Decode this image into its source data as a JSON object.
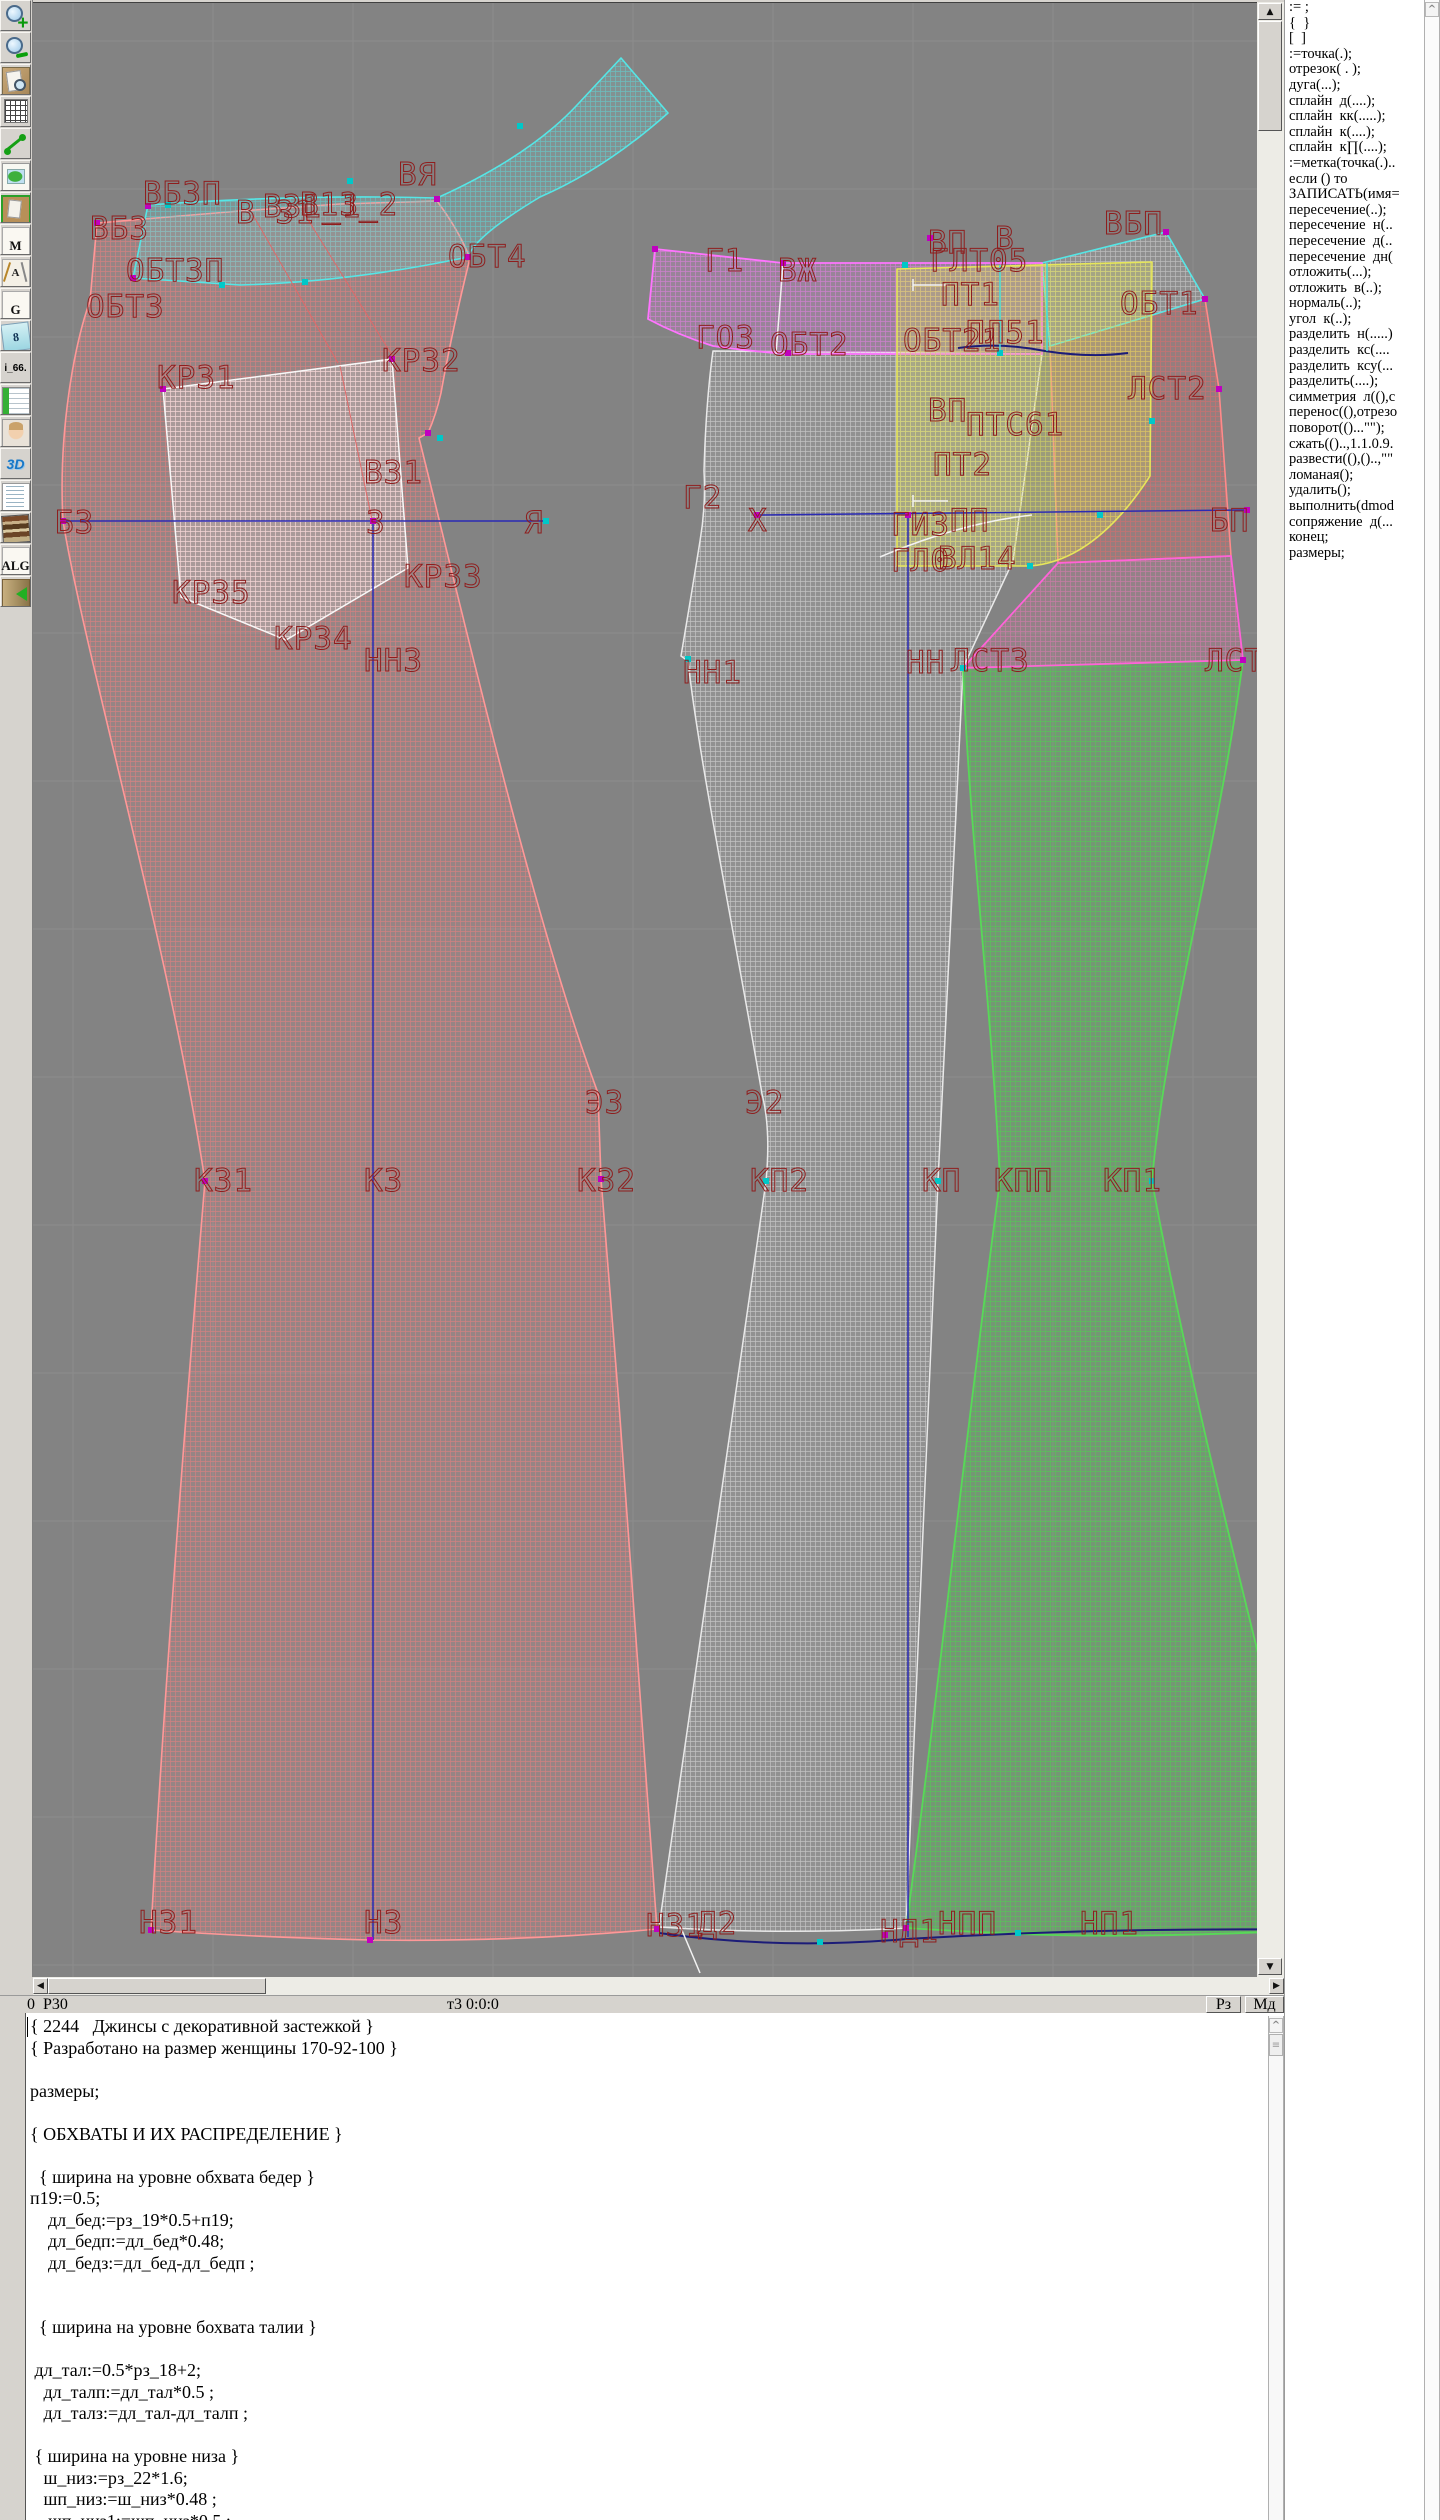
{
  "toolbar": {
    "buttons": [
      {
        "name": "zoom-in",
        "kind": "magnifier-plus",
        "glyph": ""
      },
      {
        "name": "zoom-out",
        "kind": "magnifier-minus",
        "glyph": ""
      },
      {
        "name": "print-preview",
        "kind": "page-magnifier",
        "glyph": ""
      },
      {
        "name": "grid",
        "kind": "grid",
        "glyph": ""
      },
      {
        "name": "segment",
        "kind": "segment",
        "glyph": ""
      },
      {
        "name": "map",
        "kind": "map",
        "glyph": ""
      },
      {
        "name": "pattern-frame",
        "kind": "pattern",
        "glyph": ""
      },
      {
        "name": "document-m",
        "kind": "text",
        "glyph": "M"
      },
      {
        "name": "draw-tools",
        "kind": "tools",
        "glyph": "A"
      },
      {
        "name": "document-g",
        "kind": "text",
        "glyph": "G"
      },
      {
        "name": "sizes",
        "kind": "papers",
        "glyph": "8"
      },
      {
        "name": "i66",
        "kind": "label",
        "glyph": "i_66."
      },
      {
        "name": "table",
        "kind": "table",
        "glyph": ""
      },
      {
        "name": "portrait",
        "kind": "portrait",
        "glyph": ""
      },
      {
        "name": "view-3d",
        "kind": "label3d",
        "glyph": "3D"
      },
      {
        "name": "text-list",
        "kind": "doclines",
        "glyph": ""
      },
      {
        "name": "books",
        "kind": "books",
        "glyph": ""
      },
      {
        "name": "algorithms",
        "kind": "text",
        "glyph": "ALG"
      },
      {
        "name": "exit",
        "kind": "exit",
        "glyph": ""
      }
    ]
  },
  "command_panel": {
    "items": [
      ":= ;",
      "{  }",
      "[  ]",
      ":=точка(.);",
      "отрезок( . );",
      "дуга(...);",
      "сплайн  д(....);",
      "сплайн  кк(.....);",
      "сплайн  к(....);",
      "сплайн  к∏(....);",
      ":=метка(точка(.)..",
      "если () то",
      "ЗАПИСАТЬ(имя=",
      "пересечение(..);",
      "пересечение  н(..",
      "пересечение  д(..",
      "пересечение  дн(",
      "отложить(...);",
      "отложить  в(..);",
      "нормаль(..);",
      "угол  к(..);",
      "разделить  н(.....)",
      "разделить  кс(....",
      "разделить  ксу(...",
      "разделить(....);",
      "симметрия  л((),с",
      "перенос((),отрезо",
      "поворот(()...\"\");",
      "сжать(()..,1.1.0.9.",
      "развести((),()..,\"\"",
      "ломаная();",
      "удалить();",
      "выполнить(dmod",
      "сопряжение  д(...",
      "конец;",
      "размеры;"
    ]
  },
  "status_bar": {
    "left": "0  Р30",
    "center": "т3 0:0:0",
    "buttons": [
      "Рз",
      "Мд"
    ]
  },
  "scroll_glyphs": {
    "up": "▲",
    "down": "▼",
    "left": "◀",
    "right": "▶",
    "chevron": "^",
    "thumb": "≡"
  },
  "code_editor": {
    "lines": [
      "{ 2244   Джинсы с декоративной застежкой }",
      "{ Разработано на размер женщины 170-92-100 }",
      "",
      "размеры;",
      "",
      "{ ОБХВАТЫ И ИХ РАСПРЕДЕЛЕНИЕ }",
      "",
      "  { ширина на уровне обхвата бедер }",
      "п19:=0.5;",
      "    дл_бед:=рз_19*0.5+п19;",
      "    дл_бедп:=дл_бед*0.48;",
      "    дл_бедз:=дл_бед-дл_бедп ;",
      "",
      "",
      "  { ширина на уровне бохвата талии }",
      "",
      " дл_тал:=0.5*рз_18+2;",
      "   дл_талп:=дл_тал*0.5 ;",
      "   дл_талз:=дл_тал-дл_талп ;",
      "",
      " { ширина на уровне низа }",
      "   ш_низ:=рз_22*1.6;",
      "   шп_низ:=ш_низ*0.48 ;",
      "    шп_низ1:=шп_низ*0.5 ;"
    ]
  },
  "canvas": {
    "background": "#838383",
    "grid_color": "#8d8d8d",
    "label_color": "#8f1d1d",
    "grid": {
      "vx": [
        73,
        213,
        353,
        493,
        633,
        773,
        913,
        1053,
        1193
      ],
      "hy": [
        40,
        188,
        336,
        484,
        632,
        780,
        928,
        1076,
        1224,
        1372,
        1520,
        1668,
        1816,
        1964
      ]
    },
    "pieces": [
      {
        "name": "back-left",
        "stroke": "#ff9898",
        "sw": 1.6,
        "mesh": "#ff7d7d",
        "tint": "#ff8888",
        "tintOp": 0.16,
        "meshOp": 0.55,
        "path": "M97 222 L240 210 L340 203 L437 200 C452 220 463 240 470 257 Q452 330 441 392 Q436 414 428 432 L419 437 C455 580 530 910 598 1092 L601 1178 C622 1430 641 1700 657 1928 Q520 1941 370 1939 Q250 1936 151 1929 C165 1680 185 1420 205 1180 C170 950 85 655 63 520 C58 430 75 340 90 300 Z"
      },
      {
        "name": "pocket",
        "stroke": "#f8f8f8",
        "sw": 1.5,
        "mesh": "#ffffff",
        "tint": "#ffffff",
        "tintOp": 0.18,
        "meshOp": 0.6,
        "path": "M163 388 L392 358 L408 567 L286 639 L181 596 Z"
      },
      {
        "name": "yoke-band",
        "stroke": "#55e6e6",
        "sw": 1.6,
        "mesh": "#5adada",
        "tint": "#80d8d8",
        "tintOp": 0.18,
        "meshOp": 0.6,
        "path": "M148 204 Q300 193 437 197 Q530 155 578 103 L621 57 L668 112 Q605 168 540 196 Q475 235 468 256 Q350 281 240 284 L133 277 Z"
      },
      {
        "name": "front-right",
        "stroke": "#e9e9e9",
        "sw": 1.5,
        "mesh": "#f2f2f2",
        "tint": "#e8e8e8",
        "tintOp": 0.14,
        "meshOp": 0.5,
        "path": "M713 350 L1042 353 L1013 560 L963 667 C955 840 945 1020 938 1180 C925 1430 915 1680 906 1927 Q780 1934 659 1926 C695 1680 731 1430 766 1180 Q771 1128 762 1093 C737 945 699 760 688 660 L681 655 Q692 590 700 540 Q706 505 704 470 Q706 400 713 350 Z"
      },
      {
        "name": "side-green",
        "stroke": "#58d858",
        "sw": 1.8,
        "mesh": "#4ed04e",
        "tint": "#58c858",
        "tintOp": 0.3,
        "meshOp": 0.7,
        "path": "M963 667 L1243 659 C1218 850 1166 1020 1152 1180 C1200 1440 1272 1700 1326 1928 Q1150 1938 1018 1933 Q955 1930 906 1927 C940 1680 966 1430 1000 1180 C992 1010 970 840 963 667 Z"
      },
      {
        "name": "panel-red",
        "stroke": "#ff8a8a",
        "sw": 1.6,
        "mesh": "#e86a6a",
        "tint": "#d86868",
        "tintOp": 0.22,
        "meshOp": 0.6,
        "path": "M1050 345 L1205 298 L1219 388 L1231 555 L1058 562 Z"
      },
      {
        "name": "panel-pink",
        "stroke": "#ff62d8",
        "sw": 1.8,
        "mesh": "#e878b8",
        "tint": "#d87898",
        "tintOp": 0.2,
        "meshOp": 0.6,
        "path": "M1058 562 L1231 555 L1243 659 L963 667 Z"
      },
      {
        "name": "top-right-quad",
        "stroke": "#55e6e6",
        "sw": 1.6,
        "mesh": "#e8e8e8",
        "tint": "#d8d8d8",
        "tintOp": 0.14,
        "meshOp": 0.5,
        "path": "M1042 262 L1166 231 L1205 298 L1050 345 Z"
      },
      {
        "name": "waistband-front",
        "stroke": "#ff74ff",
        "sw": 1.8,
        "mesh": "#f07df0",
        "tint": "#ee82ee",
        "tintOp": 0.2,
        "meshOp": 0.6,
        "path": "M655 248 Q718 255 783 262 L1042 262 L1042 353 L788 353 Q748 350 713 345 Q678 334 648 318 Z"
      },
      {
        "name": "fly-yellow",
        "stroke": "#e6e65a",
        "sw": 1.6,
        "mesh": "#d8d860",
        "tint": "#d8d868",
        "tintOp": 0.3,
        "meshOp": 0.7,
        "path": "M897 268 L1152 261 L1150 475 Q1095 560 1030 565 L897 565 Z"
      }
    ],
    "lines": [
      {
        "c": "#2a2ab4",
        "w": 1.5,
        "d": "M63 520 L545 520"
      },
      {
        "c": "#2a2ab4",
        "w": 1.5,
        "d": "M373 520 L373 1939"
      },
      {
        "c": "#2a2ab4",
        "w": 1.5,
        "d": "M757 514 L1247 509"
      },
      {
        "c": "#2a2ab4",
        "w": 1.5,
        "d": "M908 514 L908 1936"
      },
      {
        "c": "#1c1c78",
        "w": 2,
        "d": "M659 1932 Q780 1949 906 1938 Q1110 1926 1326 1929"
      },
      {
        "c": "#1c1c78",
        "w": 2,
        "d": "M958 347 Q1000 341 1045 350 Q1090 357 1128 352"
      },
      {
        "c": "#f2f2f2",
        "w": 1.5,
        "d": "M783 263 L776 353"
      },
      {
        "c": "#f2f2f2",
        "w": 1.5,
        "d": "M880 556 Q960 522 1032 514"
      },
      {
        "c": "#f2f2f2",
        "w": 1.5,
        "d": "M681 1927 L700 1972"
      },
      {
        "c": "#f2f2f2",
        "w": 1.5,
        "d": "M913 278 L913 290 M913 284 L948 284"
      },
      {
        "c": "#f2f2f2",
        "w": 1.5,
        "d": "M913 494 L913 506 M913 500 L948 500"
      },
      {
        "c": "#40dcdc",
        "w": 1.5,
        "d": "M1000 264 L1000 350"
      },
      {
        "c": "#40dcdc",
        "w": 1.5,
        "d": "M1047 262 L1047 350"
      },
      {
        "c": "#e06868",
        "w": 1,
        "d": "M253 214 L338 362"
      },
      {
        "c": "#e06868",
        "w": 1,
        "d": "M302 209 L395 359"
      },
      {
        "c": "#e06868",
        "w": 1,
        "d": "M340 365 L372 519"
      }
    ],
    "markers_magenta": [
      [
        97,
        222
      ],
      [
        148,
        205
      ],
      [
        133,
        277
      ],
      [
        163,
        388
      ],
      [
        392,
        358
      ],
      [
        468,
        256
      ],
      [
        437,
        198
      ],
      [
        63,
        520
      ],
      [
        373,
        520
      ],
      [
        151,
        1929
      ],
      [
        370,
        1939
      ],
      [
        657,
        1928
      ],
      [
        783,
        262
      ],
      [
        788,
        352
      ],
      [
        930,
        237
      ],
      [
        1166,
        231
      ],
      [
        1205,
        298
      ],
      [
        1219,
        388
      ],
      [
        1243,
        659
      ],
      [
        906,
        1927
      ],
      [
        1326,
        1928
      ],
      [
        885,
        1934
      ],
      [
        757,
        514
      ],
      [
        1247,
        509
      ],
      [
        655,
        248
      ],
      [
        428,
        432
      ],
      [
        908,
        514
      ],
      [
        601,
        1178
      ],
      [
        205,
        1180
      ]
    ],
    "markers_cyan": [
      [
        222,
        284
      ],
      [
        305,
        281
      ],
      [
        168,
        204
      ],
      [
        905,
        264
      ],
      [
        1000,
        352
      ],
      [
        688,
        658
      ],
      [
        963,
        667
      ],
      [
        1100,
        514
      ],
      [
        1018,
        1932
      ],
      [
        820,
        1941
      ],
      [
        546,
        520
      ],
      [
        1152,
        420
      ],
      [
        1030,
        565
      ],
      [
        440,
        437
      ],
      [
        766,
        1180
      ],
      [
        938,
        1180
      ],
      [
        1152,
        1180
      ],
      [
        350,
        180
      ],
      [
        520,
        125
      ]
    ],
    "labels": [
      {
        "t": "ВБЗП",
        "x": 143,
        "y": 203
      },
      {
        "t": "ВБЗ",
        "x": 90,
        "y": 238
      },
      {
        "t": "В 31",
        "x": 236,
        "y": 222
      },
      {
        "t": "В31_1",
        "x": 263,
        "y": 216
      },
      {
        "t": "В13_2",
        "x": 300,
        "y": 214
      },
      {
        "t": "ВЯ",
        "x": 398,
        "y": 184
      },
      {
        "t": "ОБТЗП",
        "x": 126,
        "y": 280
      },
      {
        "t": "ОБТ3",
        "x": 86,
        "y": 316
      },
      {
        "t": "ОБТ4",
        "x": 448,
        "y": 266
      },
      {
        "t": "КР31",
        "x": 157,
        "y": 387
      },
      {
        "t": "КР32",
        "x": 382,
        "y": 370
      },
      {
        "t": "В31",
        "x": 364,
        "y": 482
      },
      {
        "t": "БЗ",
        "x": 55,
        "y": 532
      },
      {
        "t": "З",
        "x": 366,
        "y": 532
      },
      {
        "t": "Я",
        "x": 524,
        "y": 532
      },
      {
        "t": "КР35",
        "x": 172,
        "y": 602
      },
      {
        "t": "КР33",
        "x": 404,
        "y": 586
      },
      {
        "t": "КР34",
        "x": 274,
        "y": 648
      },
      {
        "t": "НН3",
        "x": 364,
        "y": 670
      },
      {
        "t": "НН1",
        "x": 683,
        "y": 682
      },
      {
        "t": "ЭЗ",
        "x": 585,
        "y": 1112
      },
      {
        "t": "Э2",
        "x": 745,
        "y": 1112
      },
      {
        "t": "К31",
        "x": 194,
        "y": 1190
      },
      {
        "t": "К3",
        "x": 364,
        "y": 1190
      },
      {
        "t": "К32",
        "x": 577,
        "y": 1190
      },
      {
        "t": "КП2",
        "x": 750,
        "y": 1190
      },
      {
        "t": "КП",
        "x": 922,
        "y": 1190
      },
      {
        "t": "КПП",
        "x": 994,
        "y": 1190
      },
      {
        "t": "КП1",
        "x": 1103,
        "y": 1190
      },
      {
        "t": "Н31",
        "x": 139,
        "y": 1932
      },
      {
        "t": "Н3",
        "x": 364,
        "y": 1932
      },
      {
        "t": "НЗ1",
        "x": 646,
        "y": 1935
      },
      {
        "t": "Д2",
        "x": 698,
        "y": 1933
      },
      {
        "t": "НД1",
        "x": 880,
        "y": 1941
      },
      {
        "t": "НПП",
        "x": 938,
        "y": 1933
      },
      {
        "t": "НП1",
        "x": 1080,
        "y": 1933
      },
      {
        "t": "Г1",
        "x": 705,
        "y": 270
      },
      {
        "t": "ВЖ",
        "x": 778,
        "y": 280
      },
      {
        "t": "ГО3",
        "x": 696,
        "y": 347
      },
      {
        "t": "ОБТ2",
        "x": 770,
        "y": 354
      },
      {
        "t": "ВП",
        "x": 928,
        "y": 252
      },
      {
        "t": "В",
        "x": 995,
        "y": 248
      },
      {
        "t": "ГЛТ05",
        "x": 930,
        "y": 270
      },
      {
        "t": "ПТ1",
        "x": 941,
        "y": 304
      },
      {
        "t": "ВБП",
        "x": 1104,
        "y": 233
      },
      {
        "t": "ОБТ1",
        "x": 1120,
        "y": 313
      },
      {
        "t": "ОБТ21",
        "x": 903,
        "y": 350
      },
      {
        "t": "ПЛ51",
        "x": 966,
        "y": 342
      },
      {
        "t": "ЛСТ2",
        "x": 1128,
        "y": 398
      },
      {
        "t": "ВП",
        "x": 928,
        "y": 420
      },
      {
        "t": "ПТС61",
        "x": 966,
        "y": 434
      },
      {
        "t": "ПТ2",
        "x": 933,
        "y": 474
      },
      {
        "t": "Г2",
        "x": 683,
        "y": 507
      },
      {
        "t": "Х",
        "x": 748,
        "y": 530
      },
      {
        "t": "ГИЗ",
        "x": 891,
        "y": 534
      },
      {
        "t": "ПП",
        "x": 950,
        "y": 530
      },
      {
        "t": "БП",
        "x": 1210,
        "y": 530
      },
      {
        "t": "ГЛ0",
        "x": 891,
        "y": 570
      },
      {
        "t": "ВЛ14",
        "x": 938,
        "y": 568
      },
      {
        "t": "НН",
        "x": 906,
        "y": 672
      },
      {
        "t": "ЛСТ3",
        "x": 951,
        "y": 670
      },
      {
        "t": "ЛСТ4",
        "x": 1205,
        "y": 670
      }
    ]
  }
}
